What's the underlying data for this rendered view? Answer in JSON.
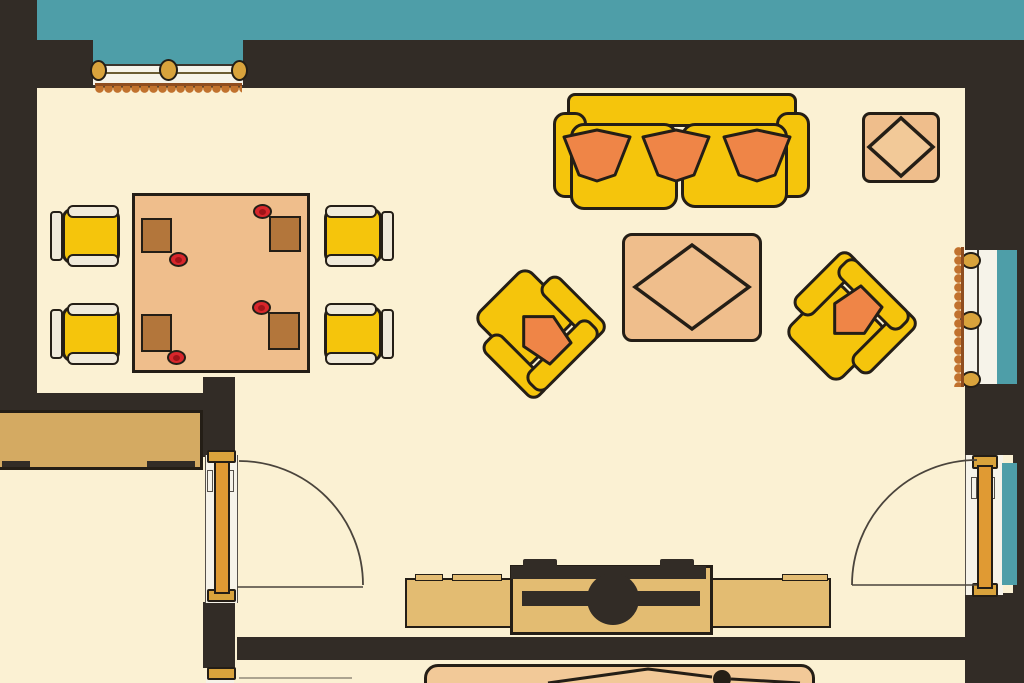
{
  "scene": {
    "title": "living-dining-room-floor-plan",
    "style": "flat-color illustration, top-down architectural view",
    "rooms": [
      "main living-dining room",
      "bottom-left room",
      "bottom-center room"
    ]
  },
  "colors": {
    "outside_teal": "#4E9EA8",
    "wall": "#322C26",
    "floor": "#FBF1D3",
    "furniture_yellow": "#F5C50C",
    "pillow_orange": "#EF8547",
    "wood_tan": "#EFBE8C",
    "wood_tan_light": "#F2C998",
    "placemat_brown": "#B3763B",
    "plate_red": "#D8262B",
    "plate_red_dark": "#9E1418",
    "counter_tan": "#D4AA62",
    "console_tan": "#E3BC72",
    "door_gold": "#E09A33",
    "hardware_gold": "#D9A33C",
    "trim_white": "#F6F3E9",
    "chairbar_cream": "#F0EADA",
    "scallop_orange": "#C1722E",
    "scallop_edge": "#8F4D1F",
    "outline_dark": "#241E16",
    "swing_line": "#4A443C"
  },
  "architecture": {
    "windows": [
      "top-wall window with curtain frill",
      "right-wall window with curtain frill"
    ],
    "doors": [
      "left interior door with swing arc",
      "right exterior door with swing arc",
      "bottom-left door (partial)"
    ],
    "walls": [
      "top exterior wall",
      "left exterior wall",
      "right exterior wall",
      "interior partition walls",
      "bottom partition wall"
    ]
  },
  "furniture": {
    "dining_table": {
      "placemats": 4,
      "plates": 4
    },
    "dining_chairs": 4,
    "sofa": {
      "seat_cushions": 2,
      "pillows": 3
    },
    "armchairs": {
      "count": 2,
      "pillows": 2,
      "rotation_deg": [
        -45,
        -135
      ]
    },
    "coffee_table": {
      "decor": "diamond inlay"
    },
    "ottoman_side_table": {
      "decor": "diamond inlay"
    },
    "tv_console": {
      "tv": "center unit with round base"
    },
    "sideboard_counter": 1,
    "bottom_room_furniture_partial": 1
  }
}
